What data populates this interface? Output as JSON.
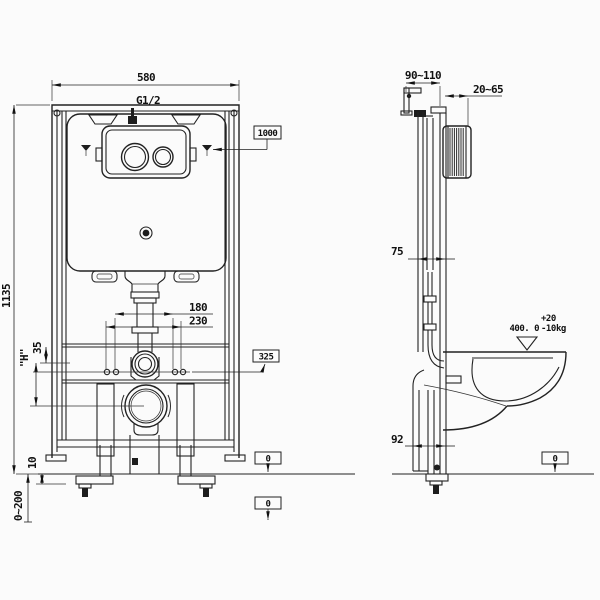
{
  "drawing": {
    "front_view": {
      "frame_width": "580",
      "inlet_thread": "G1/2",
      "frame_height": "1135",
      "install_height_ref": "1000",
      "bolt_spacing_inner": "180",
      "bolt_spacing_outer": "230",
      "outlet_height_ref": "325",
      "drain_offset": "35",
      "variable_height": "\"H\"",
      "floor_clearance": "10",
      "floor_adjust_range": "0~200",
      "floor_ref_upper": "0",
      "floor_ref_lower": "0"
    },
    "side_view": {
      "bracket_depth_range": "90~110",
      "wall_finish_range": "20~65",
      "frame_depth": "75",
      "base_depth": "92",
      "load_value": "400. 0",
      "load_tol_plus": "+20",
      "load_tol_minus": "-10",
      "load_unit": "kg",
      "floor_ref": "0"
    }
  }
}
